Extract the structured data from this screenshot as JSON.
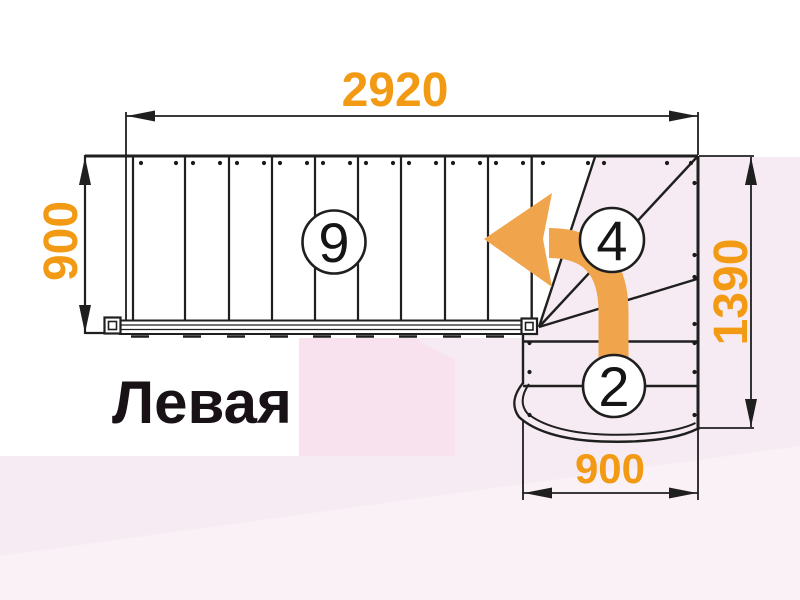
{
  "diagram": {
    "title": "Левая",
    "dimensions": {
      "top": "2920",
      "left": "900",
      "right": "1390",
      "bottom": "900"
    },
    "steps": {
      "straight": "9",
      "winder": "4",
      "bottom": "2"
    },
    "colors": {
      "dimension_text": "#f39a15",
      "arrow_fill": "#f0a44c",
      "line": "#1f1f1f",
      "background_pink": "#f6ebf2",
      "background_rose": "#f8e2ee"
    }
  }
}
